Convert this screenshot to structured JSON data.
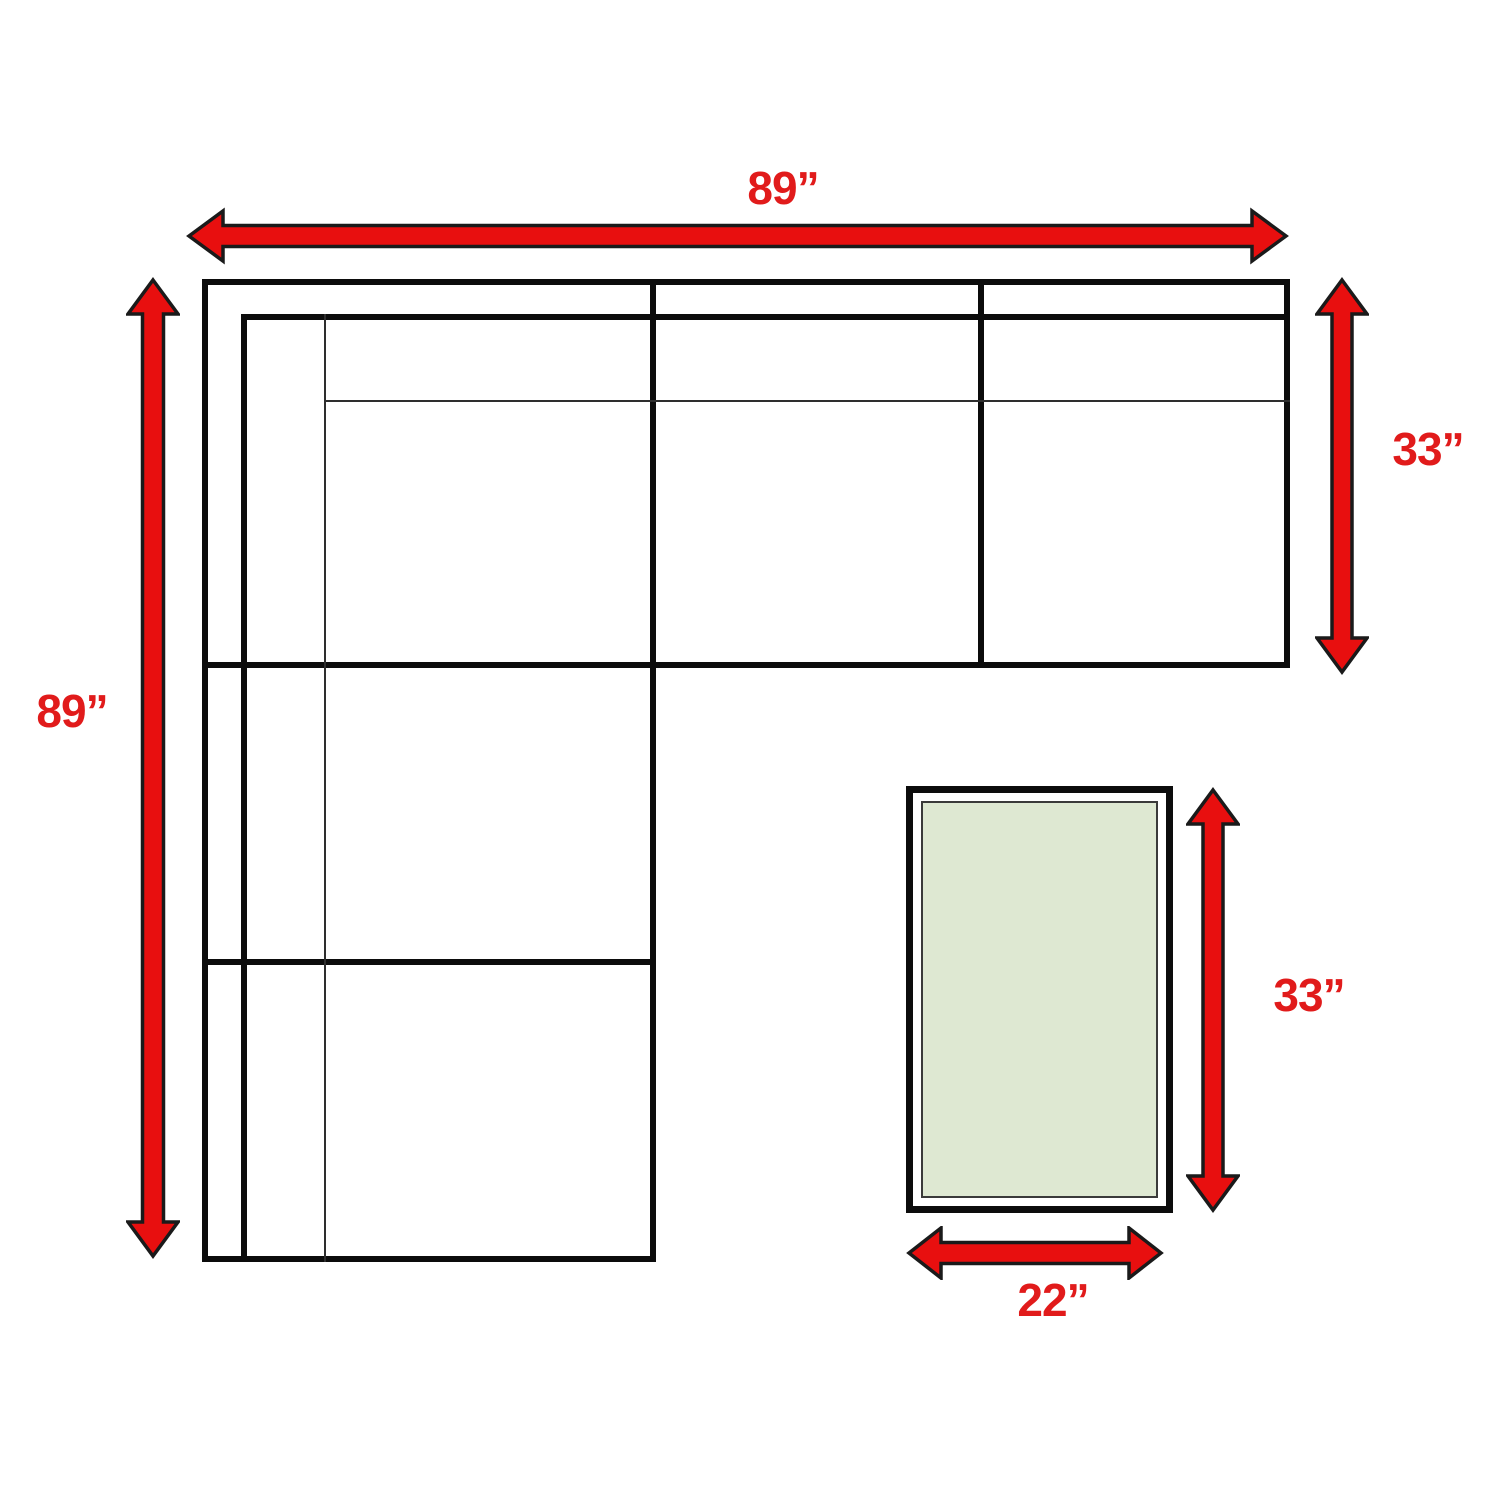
{
  "diagram": {
    "title": "sectional-sofa-and-ottoman-dimension-diagram",
    "sofa": {
      "width_label": "89”",
      "height_label": "89”",
      "depth_label": "33”"
    },
    "ottoman": {
      "length_label": "33”",
      "width_label": "22”"
    },
    "colors": {
      "arrow-fill": "#e80f0f",
      "arrow-outline": "#1a1a1a",
      "label-red": "#e11b1b",
      "line-black": "#0c0c0c",
      "ottoman-fill": "#dee8d2",
      "background": "#ffffff"
    }
  }
}
